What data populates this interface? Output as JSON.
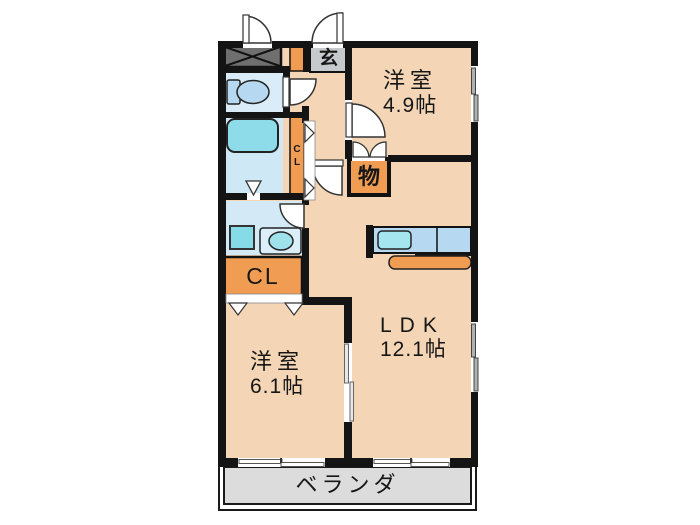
{
  "plan_title": "apartment-floor-plan",
  "rooms": {
    "bedroom1": {
      "name": "洋室",
      "size": "4.9帖"
    },
    "bedroom2": {
      "name": "洋室",
      "size": "6.1帖"
    },
    "ldk": {
      "name": "LDK",
      "size": "12.1帖"
    },
    "balcony": {
      "name": "ベランダ"
    },
    "entrance": {
      "name": "玄"
    },
    "storage": {
      "name": "物"
    },
    "closet": {
      "name": "CL"
    },
    "hall_closet": {
      "line1": "C",
      "line2": "L"
    }
  },
  "colors": {
    "floor": "#f4d6b7",
    "closet_orange": "#f09d53",
    "bath_cyan": "#8edce9",
    "fixture_blue": "#b7d8f1",
    "toilet_floor": "#d9ecf8",
    "bath_floor": "#cfe8f6",
    "washroom_floor": "#d4e9f6",
    "balcony_gray": "#dcdcdc",
    "entrance_gray": "#c6cacd",
    "meter_box_gray": "#6f6f6f",
    "wall": "#141414"
  }
}
